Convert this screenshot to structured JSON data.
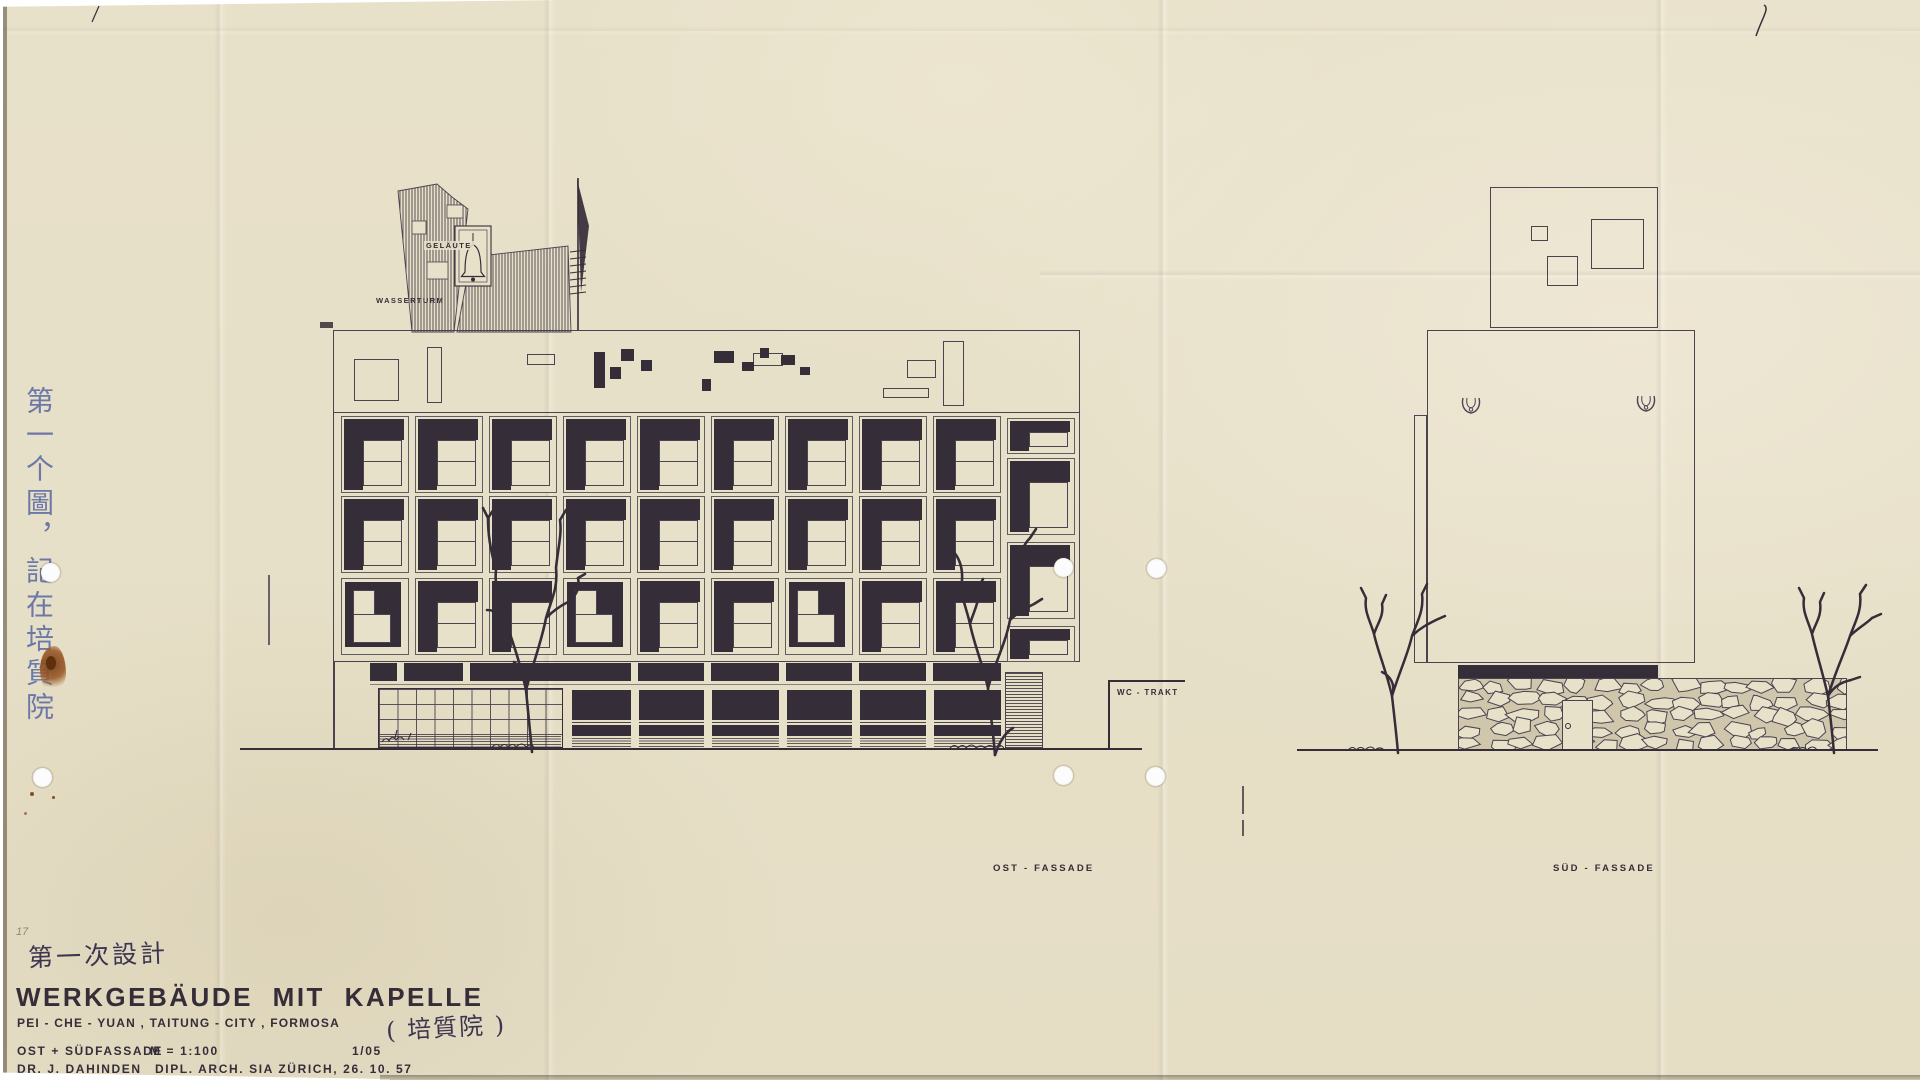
{
  "sheet": {
    "pencil_number": "17",
    "handwritten_note_vertical": "第一个圖，記在培質院",
    "handwritten_design_note": "第一次設計",
    "handwritten_paren_note": "( 培質院 )",
    "title": "WERKGEBÄUDE MIT KAPELLE",
    "subtitle": "PEI - CHE - YUAN , TAITUNG - CITY , FORMOSA",
    "scale_label": "OST + SÜDFASSADE",
    "scale_value": "M = 1:100",
    "sheet_number": "1/05",
    "author_name": "DR. J. DAHINDEN",
    "author_credentials": "DIPL. ARCH. SIA  ZÜRICH, 26. 10. 57"
  },
  "labels": {
    "bell_tower": "GELÄUTE",
    "water_tower": "WASSERTURM",
    "wc_wing": "WC - TRAKT",
    "east_elevation": "OST - FASSADE",
    "south_elevation": "SÜD - FASSADE"
  },
  "east_facade": {
    "grid_rows": [
      "GGGGGGGGG",
      "GGGGGGGGG",
      "RGGRGGRGG"
    ],
    "stair_column_cells": [
      [
        87,
        36
      ],
      [
        127,
        77
      ],
      [
        211,
        77
      ],
      [
        295,
        36
      ]
    ],
    "roof_outline_rects": [
      [
        20,
        28,
        45,
        42
      ],
      [
        93,
        16,
        15,
        56
      ],
      [
        193,
        23,
        28,
        11
      ],
      [
        419,
        22,
        30,
        13
      ],
      [
        549,
        57,
        46,
        10
      ],
      [
        573,
        29,
        29,
        18
      ],
      [
        609,
        10,
        21,
        65
      ]
    ],
    "roof_black_rects": [
      [
        260,
        21,
        11,
        36
      ],
      [
        276,
        36,
        11,
        12
      ],
      [
        287,
        18,
        13,
        12
      ],
      [
        307,
        29,
        11,
        11
      ],
      [
        368,
        48,
        9,
        12
      ],
      [
        380,
        20,
        20,
        12
      ],
      [
        408,
        31,
        12,
        9
      ],
      [
        426,
        17,
        9,
        10
      ],
      [
        447,
        24,
        14,
        10
      ],
      [
        466,
        36,
        10,
        8
      ]
    ]
  },
  "colors": {
    "paper": "#e8e1ca",
    "ink": "#352d37",
    "thin_line": "#4b4350",
    "blue_ink": "#5e6da6",
    "rust_stain": "#8a4d1e",
    "mortar": "#cfc6ab"
  }
}
